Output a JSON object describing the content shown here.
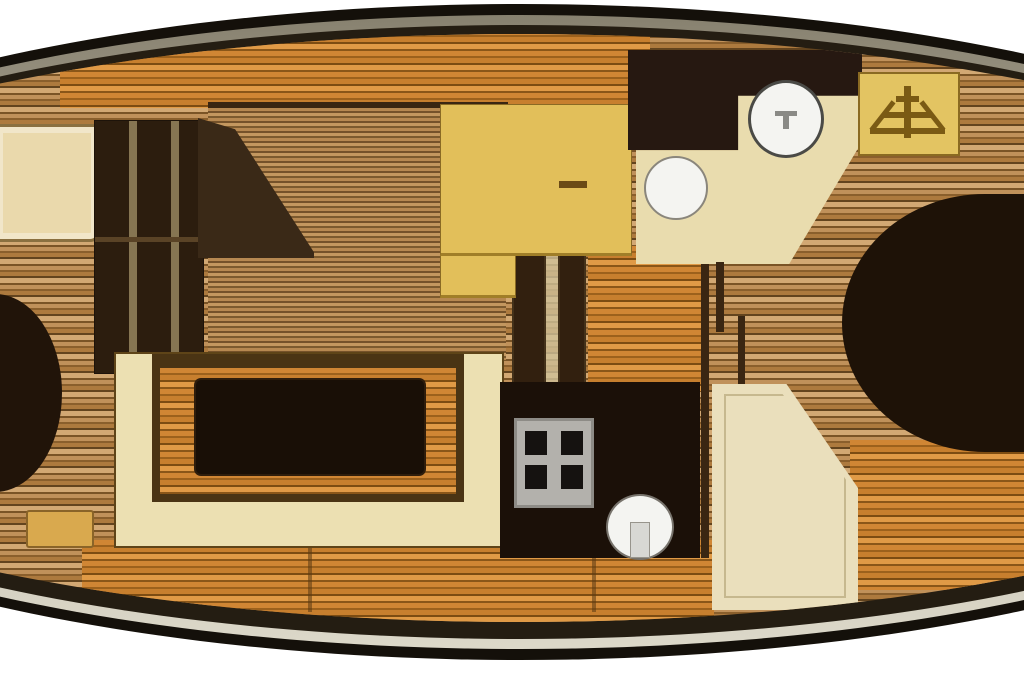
{
  "diagram": {
    "type": "boat-floorplan",
    "title": "Motor yacht interior layout plan (top-down view)",
    "orientation": "bow-left",
    "visible_text": "",
    "regions": [
      {
        "id": "forward-cabin",
        "label": "Forward cabin with berth, wardrobe and cabinet"
      },
      {
        "id": "saloon",
        "label": "Saloon with U-shaped settee and dining table"
      },
      {
        "id": "galley",
        "label": "Galley with counter, stove and round sink"
      },
      {
        "id": "head",
        "label": "Head compartment with toilet, washbasin, shower and counter"
      },
      {
        "id": "companionway",
        "label": "Companionway steps panel to deck"
      },
      {
        "id": "aft-cabin",
        "label": "Aft cabin with double berth and vanity desk"
      }
    ],
    "fixtures": {
      "hull": {
        "label": "Boat hull outline with rub rail"
      },
      "forward_berth": {
        "label": "Forward berth cushion"
      },
      "forward_cabinet": {
        "label": "Forward cabin cabinet"
      },
      "wardrobe": {
        "label": "Wardrobe with sliding doors"
      },
      "angled_partition": {
        "label": "Angled partition bulkhead"
      },
      "side_step": {
        "label": "Small side step"
      },
      "settee": {
        "label": "U-shaped saloon settee"
      },
      "table": {
        "label": "Saloon table"
      },
      "posts": {
        "label": "Partition posts amidships"
      },
      "galley_counter": {
        "label": "Galley countertop"
      },
      "stove": {
        "label": "Galley stove with four burners"
      },
      "galley_sink": {
        "label": "Round galley sink"
      },
      "shower": {
        "label": "Shower compartment"
      },
      "head_counter": {
        "label": "Head counter with angled edge"
      },
      "toilet": {
        "label": "Toilet bowl"
      },
      "washbasin": {
        "label": "Round washbasin"
      },
      "companionway_steps": {
        "label": "Companionway steps"
      },
      "aft_berth": {
        "label": "Aft double berth"
      },
      "vanity_desk": {
        "label": "Aft cabin vanity desk"
      }
    },
    "palette": {
      "background": "#ffffff",
      "hull_outline": "#14100a",
      "rub_rail_dark": "#87816f",
      "rub_rail_light": "#dcd8c9",
      "deck_plank_light": "#d2a873",
      "deck_plank_mid": "#c0915a",
      "deck_plank_dark": "#63441e",
      "floor_orange": "#d08634",
      "cabinetry_cream": "#ece0b2",
      "counter_yellow": "#e2bf5a",
      "furniture_dark_wood": "#2c1d0e",
      "table_black": "#190f06",
      "berth_dark": "#211409",
      "galley_unit_black": "#1b1008",
      "stove_gray": "#b3b1ac",
      "fixture_white": "#f4f4f1"
    }
  }
}
